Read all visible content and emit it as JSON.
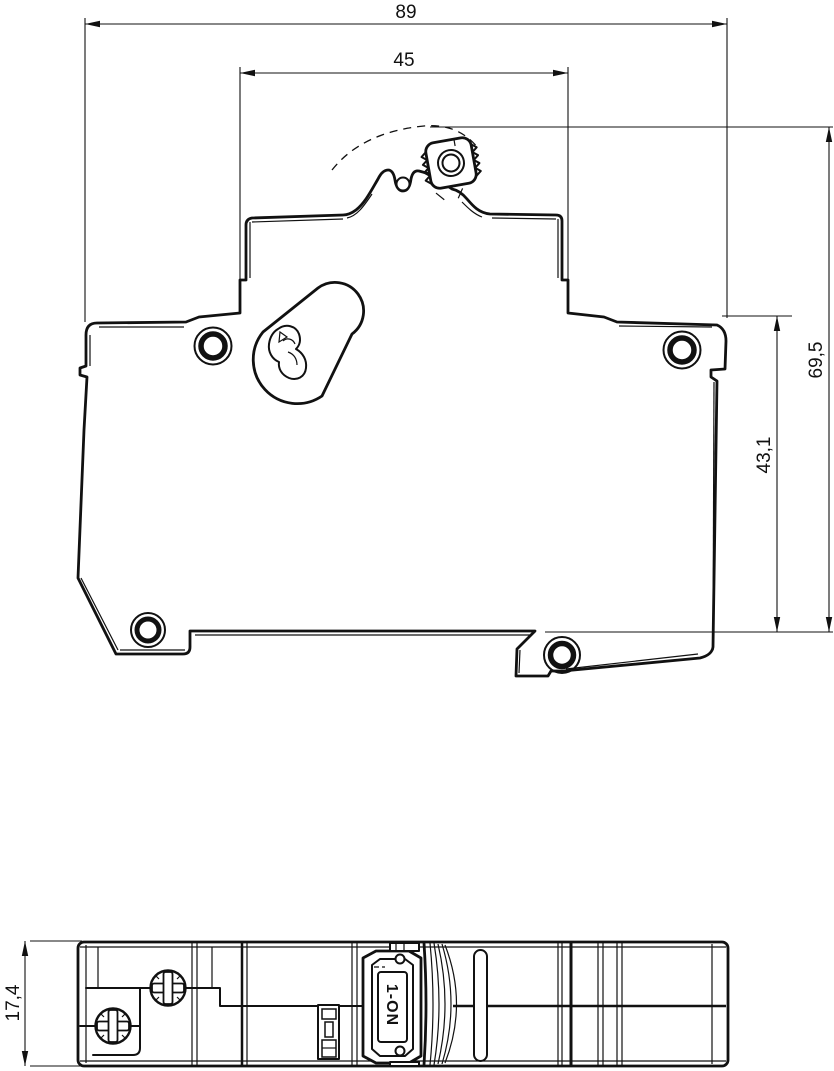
{
  "page": {
    "background": "#ffffff",
    "line_color": "#111111"
  },
  "side_view": {
    "description": "circuit-breaker-side-profile",
    "dim_overall_width": "89",
    "dim_handle_width": "45",
    "dim_total_height": "69,5",
    "dim_body_height": "43,1"
  },
  "bottom_view": {
    "description": "circuit-breaker-module-profile",
    "dim_module_width": "17,4",
    "toggle_label": "1-ON"
  }
}
